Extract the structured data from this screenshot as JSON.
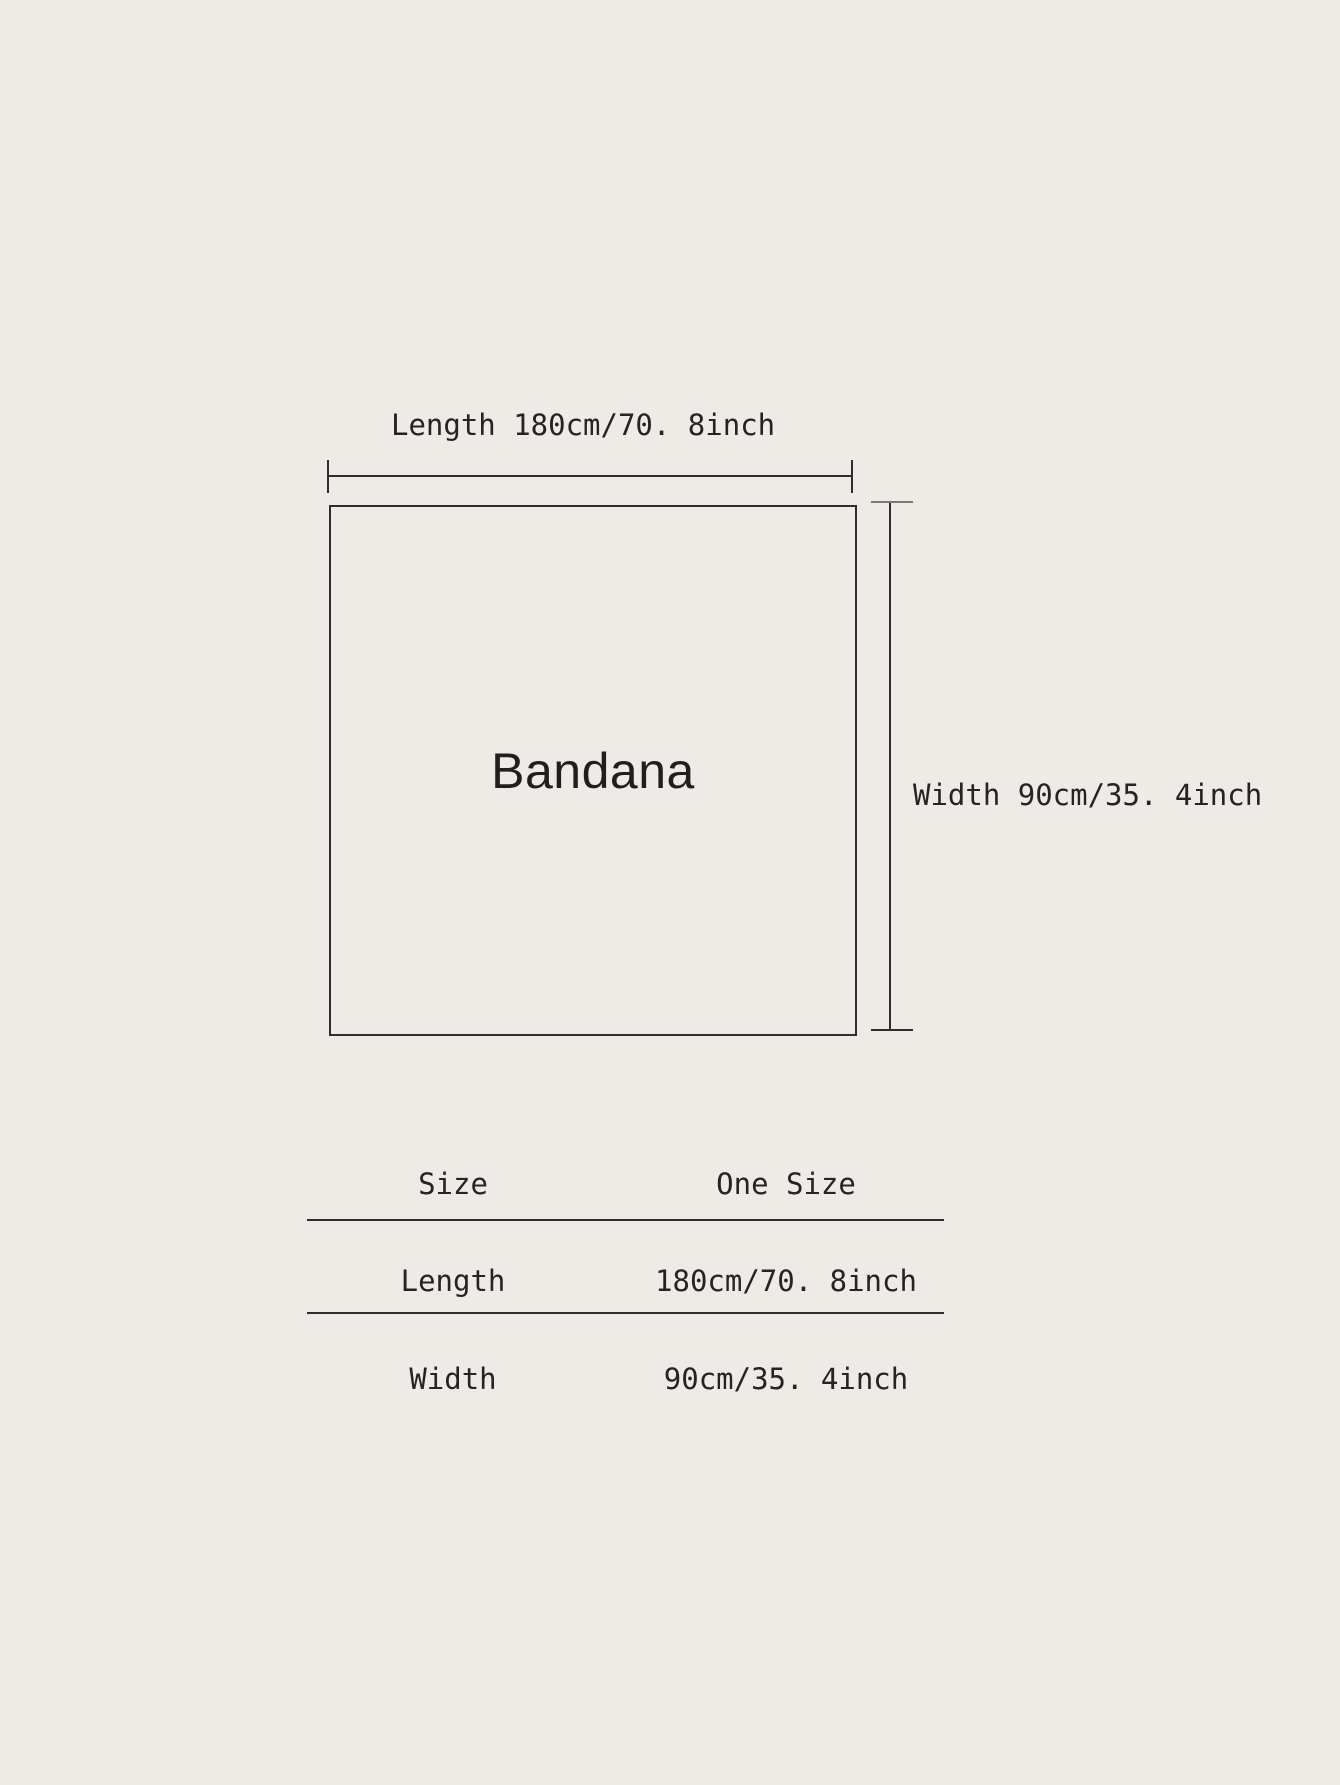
{
  "colors": {
    "background": "#EEEAE6",
    "line": "#2e2e2e",
    "text": "#242424"
  },
  "diagram": {
    "product_label": "Bandana",
    "length_label": "Length 180cm/70. 8inch",
    "width_label": "Width 90cm/35. 4inch"
  },
  "size_table": {
    "rows": [
      {
        "label": "Size",
        "value": "One Size"
      },
      {
        "label": "Length",
        "value": "180cm/70. 8inch"
      },
      {
        "label": "Width",
        "value": "90cm/35. 4inch"
      }
    ]
  }
}
